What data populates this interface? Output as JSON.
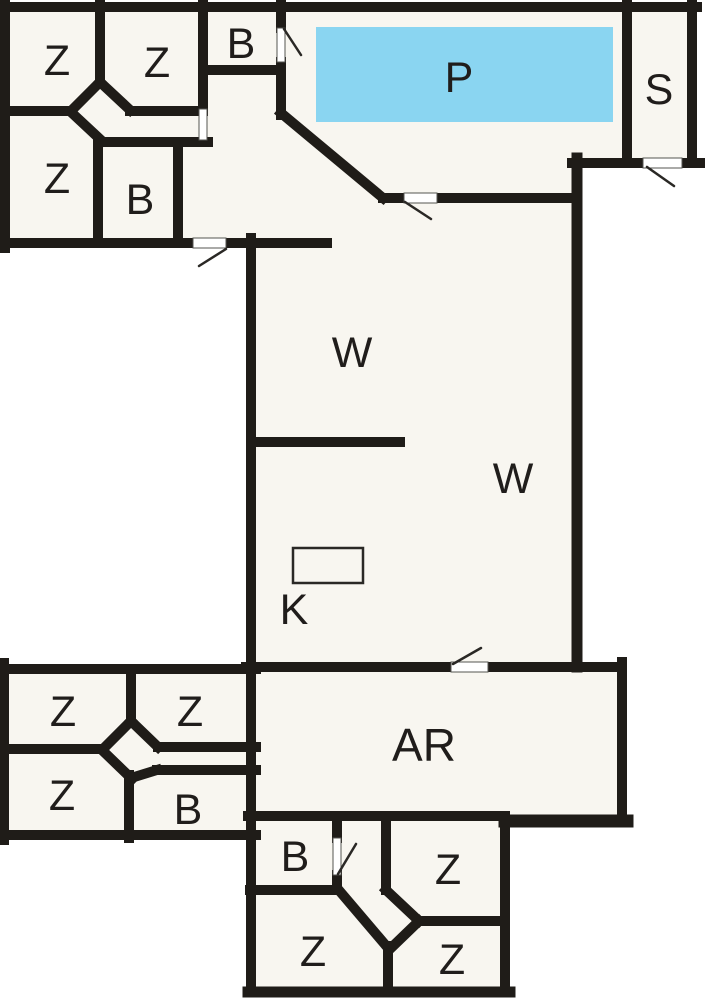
{
  "floorplan": {
    "colors": {
      "wall": "#1f1c18",
      "floor": "#f8f6f0",
      "outside": "#ffffff",
      "pool": "#8ad5f1",
      "label": "#201d1b"
    },
    "rooms": [
      {
        "key": "bedroom-nw-1",
        "label": "Z"
      },
      {
        "key": "bedroom-nw-2",
        "label": "Z"
      },
      {
        "key": "bath-north",
        "label": "B"
      },
      {
        "key": "bedroom-nw-3",
        "label": "Z"
      },
      {
        "key": "bath-nw",
        "label": "B"
      },
      {
        "key": "pool-room",
        "label": "P"
      },
      {
        "key": "sauna-room",
        "label": "S"
      },
      {
        "key": "living-area-upper",
        "label": "W"
      },
      {
        "key": "living-area-lower",
        "label": "W"
      },
      {
        "key": "kitchen",
        "label": "K"
      },
      {
        "key": "activity-room",
        "label": "AR"
      },
      {
        "key": "bedroom-sw-1",
        "label": "Z"
      },
      {
        "key": "bedroom-sw-2",
        "label": "Z"
      },
      {
        "key": "bedroom-sw-3",
        "label": "Z"
      },
      {
        "key": "bath-sw",
        "label": "B"
      },
      {
        "key": "bath-south",
        "label": "B"
      },
      {
        "key": "bedroom-s-1",
        "label": "Z"
      },
      {
        "key": "bedroom-s-2",
        "label": "Z"
      },
      {
        "key": "bedroom-s-3",
        "label": "Z"
      }
    ]
  }
}
